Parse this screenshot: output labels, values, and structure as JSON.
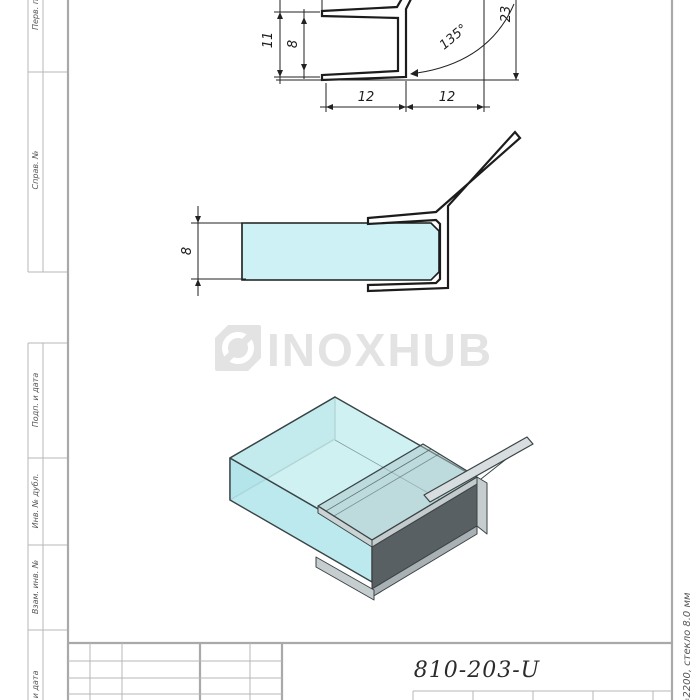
{
  "sheet": {
    "designation": "810-203-U",
    "side_note": "=2200, стекло 8.0 мм",
    "stamp_labels_left": [
      "Перв. примен.",
      "Справ. №",
      "Подп. и дата",
      "Инв. № дубл.",
      "Взам. инв. №",
      "Подп. и дата"
    ]
  },
  "logo": {
    "text": "INOXHUB"
  },
  "dims": {
    "top_view": {
      "d11": "11",
      "d8": "8",
      "d12_left": "12",
      "d12_right": "12",
      "angle": "135°",
      "d23": "23"
    },
    "side_view": {
      "d8": "8"
    }
  },
  "colors": {
    "glass": "#cdf1f5",
    "glass_3d_top": "#c8eef0",
    "glass_3d_front": "#b5e7eb",
    "profile_dark_web": "#596063",
    "drawing_line": "#1c1c1c",
    "frame_line": "#b2b2b2",
    "logo_gray": "#e3e3e3"
  }
}
